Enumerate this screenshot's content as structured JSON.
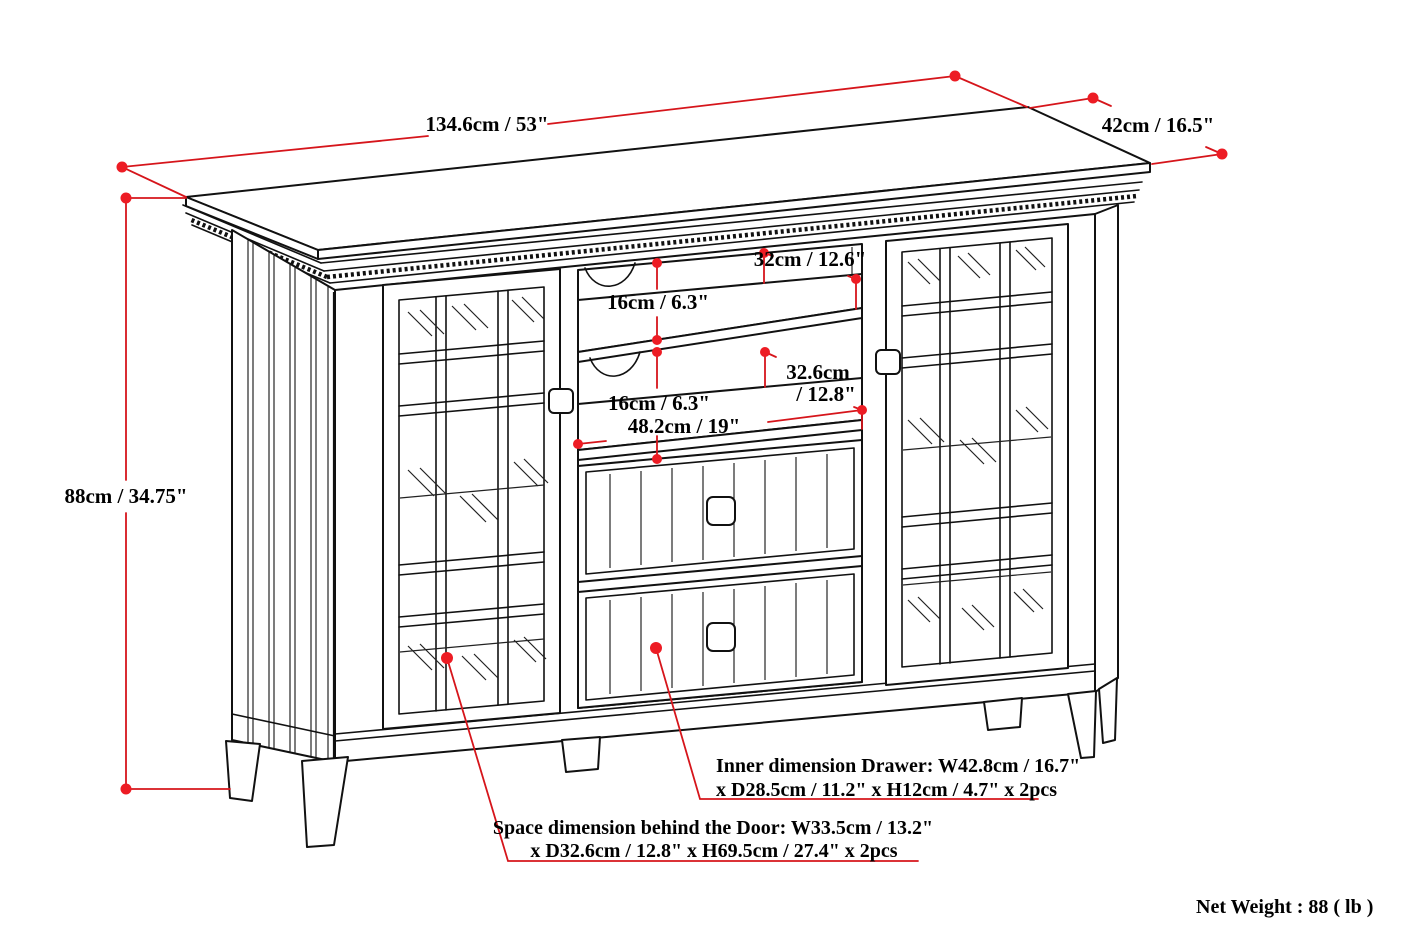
{
  "product": {
    "dimensions": {
      "width": "134.6cm / 53\"",
      "depth": "42cm / 16.5\"",
      "height": "88cm / 34.75\"",
      "shelf_opening_depth": "32cm / 12.6\"",
      "shelf_opening_height_upper": "16cm / 6.3\"",
      "shelf_opening_height_lower": "16cm / 6.3\"",
      "lower_shelf_depth_cm": "32.6cm",
      "lower_shelf_depth_in": "/ 12.8\"",
      "center_opening_width": "48.2cm / 19\""
    },
    "notes": {
      "drawer_inner_line1": "Inner dimension Drawer: W42.8cm / 16.7\"",
      "drawer_inner_line2": "x D28.5cm / 11.2\" x H12cm / 4.7\" x 2pcs",
      "door_space_line1": "Space dimension behind the Door: W33.5cm / 13.2\"",
      "door_space_line2": "x D32.6cm / 12.8\" x H69.5cm / 27.4\" x 2pcs",
      "net_weight": "Net Weight : 88 ( lb )"
    },
    "colors": {
      "dimension_red": "#d6151b",
      "dot_red": "#ed1c24",
      "ink": "#111111",
      "background": "#ffffff"
    }
  }
}
